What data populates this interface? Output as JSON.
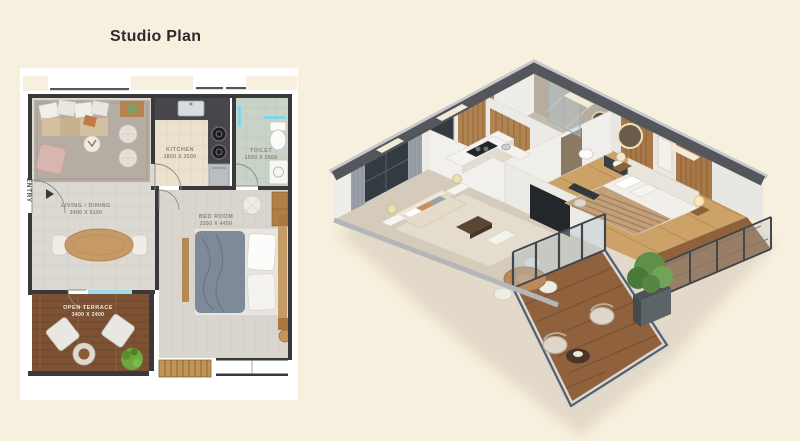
{
  "page": {
    "title": "Studio Plan",
    "background": "#f8f0de"
  },
  "plan2d": {
    "entry": "ENTRY",
    "rooms": {
      "living": {
        "name": "LIVING / DINING",
        "dims": "3400 X 5150"
      },
      "kitchen": {
        "name": "KITCHEN",
        "dims": "1850 X 2500"
      },
      "toilet": {
        "name": "TOILET",
        "dims": "1500 X 2500"
      },
      "bedroom": {
        "name": "BED ROOM",
        "dims": "3350 X 4450"
      },
      "terrace": {
        "name": "OPEN TERRACE",
        "dims": "3400 X 2400"
      }
    }
  },
  "colors": {
    "accent_cyan": "#7fd6e8",
    "wall_dark": "#39393b",
    "terrace_wood": "#7d5234",
    "iso_wall_top": "#53575b"
  }
}
